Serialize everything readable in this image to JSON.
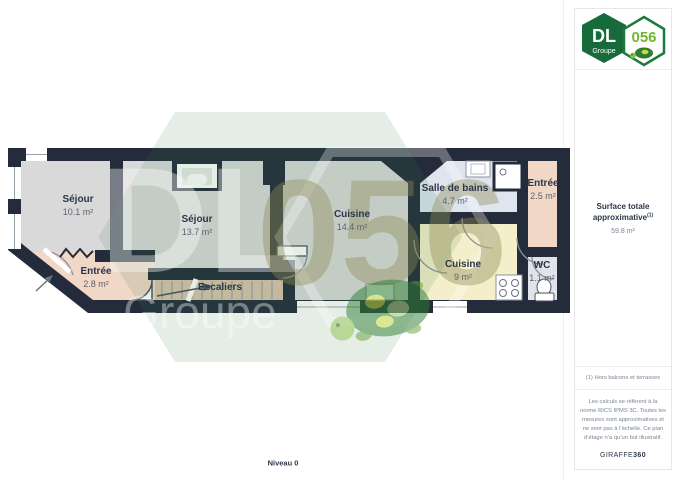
{
  "logo": {
    "dl": "DL",
    "groupe": "Groupe",
    "number": "056"
  },
  "watermark": {
    "dl": "DL",
    "groupe": "Groupe",
    "number": "056"
  },
  "floorplan": {
    "level_label": "Niveau 0",
    "rooms": [
      {
        "name": "Séjour",
        "area": "10.1 m²"
      },
      {
        "name": "Séjour",
        "area": "13.7 m²"
      },
      {
        "name": "Cuisine",
        "area": "14.4 m²"
      },
      {
        "name": "Salle de bains",
        "area": "4.7 m²"
      },
      {
        "name": "Entrée",
        "area": "2.5 m²"
      },
      {
        "name": "Cuisine",
        "area": "9 m²"
      },
      {
        "name": "WC",
        "area": "1.1 m²"
      },
      {
        "name": "Entrée",
        "area": "2.8 m²"
      },
      {
        "name": "Escaliers"
      }
    ]
  },
  "sidebar": {
    "surface_title": "Surface totale approximative",
    "surface_note_ref": "(1)",
    "surface_value": "59.8 m²",
    "footnote": "(1) Hors balcons et terrasses",
    "disclaimer": "Les calculs se réfèrent à la norme RICS IPMS 3C. Toutes les mesures sont approximatives et ne sont pas à l’échelle. Ce plan d’étage n’a qu’un but illustratif.",
    "brand_name": "GIRAFFE",
    "brand_number": "360"
  },
  "colors": {
    "wall": "#242c3b",
    "brand_green": "#176a39",
    "floor_gray": "#d9d9d9",
    "floor_yellow": "#f4eecb",
    "floor_blue": "#dee5ef",
    "floor_salmon": "#f0d7c6",
    "floor_tan": "#d9c3ac"
  }
}
